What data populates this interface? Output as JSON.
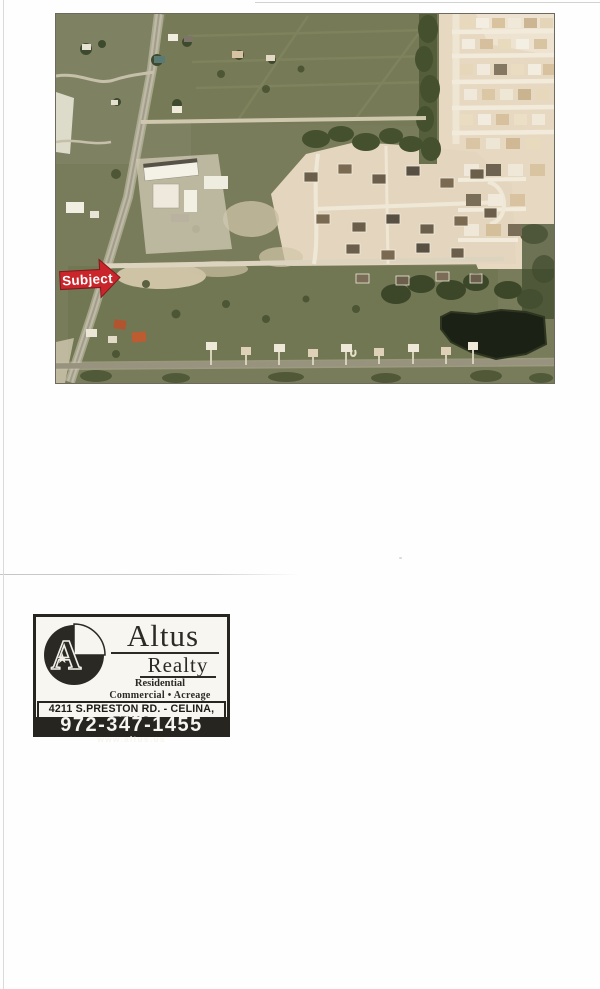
{
  "page": {
    "background": "#fefefe",
    "artifact_line_color": "#cfcfcd"
  },
  "aerial_photo": {
    "description": "Aerial satellite photo: subject property on a diagonal two-lane road, green fields at left, white commercial buildings, a new home subdivision under construction (tan) to the east, rows of homes at top right, dark pond at lower right, road across the bottom",
    "border_color": "#6b6a5c",
    "palette": {
      "grass": "#797c5b",
      "grass_light": "#83866a",
      "trees_dark": "#44502e",
      "road_light": "#cfc8b2",
      "road_gray": "#96927f",
      "construction_tan": "#e4d6be",
      "construction_light": "#eee3d0",
      "building_white": "#f2efe4",
      "pond": "#1c2115",
      "roof_dark": "#6b5e4a",
      "roof_red": "#b4532f"
    },
    "subject_marker": {
      "label": "Subject",
      "arrow_color": "#c9252b",
      "arrow_outline": "#7e191d",
      "text_color": "#ffffff"
    }
  },
  "business_card": {
    "brand_line1": "Altus",
    "brand_line2": "Realty",
    "tagline_line1": "Residential",
    "tagline_line2": "Commercial • Acreage",
    "address": "4211 S.PRESTON RD. - CELINA, TEXAS",
    "phone": "972-347-1455",
    "website": "www.altus.us",
    "logo_letter": "A",
    "colors": {
      "ink": "#26251f",
      "paper": "#f8f6f1"
    }
  },
  "icons": {
    "star": "★"
  }
}
